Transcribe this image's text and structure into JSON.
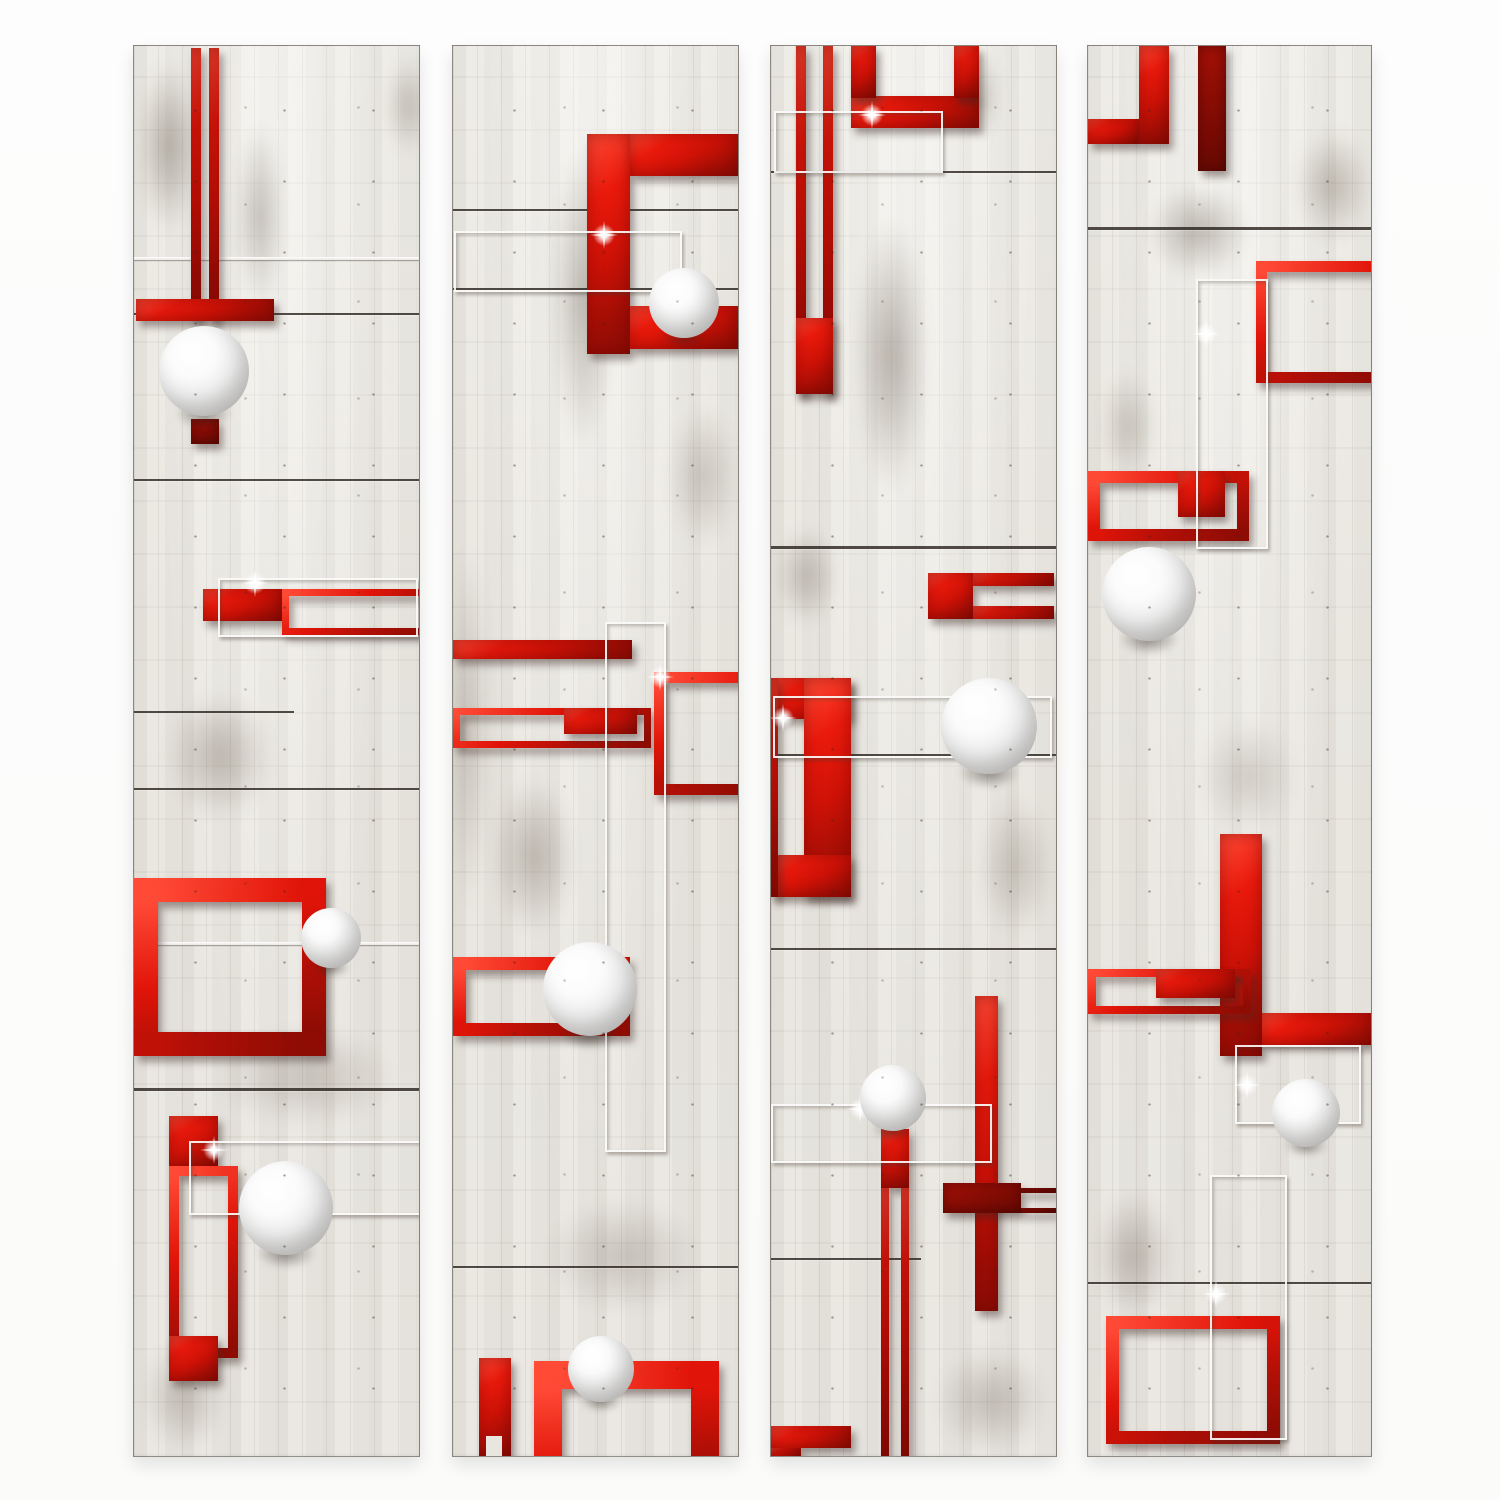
{
  "artwork": {
    "kind": "decorative wallpaper mural, abstract 3D composition",
    "motifs": "concrete/wood plank panels, glossy red rectangles and frames, white 3D spheres, thin silver wire frames"
  },
  "palette": {
    "page_bg": "#fcfcfc",
    "panel_bg": "#eae7e1",
    "red_bright": "#ea1a0c",
    "red_deep": "#8d0c04",
    "dark_red": "#8a0d05",
    "seam": "#231c16",
    "wire_silver": "#faf9f7",
    "sphere_white": "#ffffff",
    "sphere_edge": "#b9b9ba"
  },
  "canvas": {
    "w": 1500,
    "h": 1500
  },
  "panels": [
    {
      "id": "panel-1",
      "x": 133,
      "y": 45,
      "w": 285,
      "h": 1410,
      "shapes": [
        {
          "t": "smudge",
          "x": -10,
          "y": -20,
          "w": 90,
          "h": 240,
          "a": 0.5
        },
        {
          "t": "smudge",
          "x": 90,
          "y": 40,
          "w": 70,
          "h": 260,
          "a": 0.4
        },
        {
          "t": "smudge",
          "x": 240,
          "y": -10,
          "w": 70,
          "h": 140,
          "a": 0.35
        },
        {
          "t": "smudge",
          "x": 10,
          "y": 620,
          "w": 150,
          "h": 180,
          "a": 0.4
        },
        {
          "t": "smudge",
          "x": 40,
          "y": 960,
          "w": 260,
          "h": 140,
          "a": 0.3
        },
        {
          "t": "smudge",
          "x": -10,
          "y": 1270,
          "w": 120,
          "h": 160,
          "a": 0.35
        },
        {
          "t": "seam",
          "x": 0,
          "y": 267,
          "w": 285,
          "h": 2
        },
        {
          "t": "seam",
          "x": 0,
          "y": 433,
          "w": 285,
          "h": 2
        },
        {
          "t": "seam",
          "x": 0,
          "y": 665,
          "w": 160,
          "h": 2
        },
        {
          "t": "seam",
          "x": 0,
          "y": 742,
          "w": 285,
          "h": 2
        },
        {
          "t": "seam",
          "x": 0,
          "y": 1042,
          "w": 285,
          "h": 3
        },
        {
          "t": "wireline",
          "x": 0,
          "y": 211,
          "w": 285,
          "h": 3
        },
        {
          "t": "wireline",
          "x": 0,
          "y": 896,
          "w": 285,
          "h": 3
        },
        {
          "t": "bar",
          "x": 57,
          "y": 2,
          "w": 10,
          "h": 273
        },
        {
          "t": "bar",
          "x": 75,
          "y": 2,
          "w": 10,
          "h": 273
        },
        {
          "t": "bar",
          "x": 2,
          "y": 253,
          "w": 138,
          "h": 22
        },
        {
          "t": "bar",
          "x": 57,
          "y": 373,
          "w": 28,
          "h": 25,
          "c": "darkred"
        },
        {
          "t": "bar",
          "x": 69,
          "y": 543,
          "w": 79,
          "h": 32
        },
        {
          "t": "frame",
          "x": 148,
          "y": 543,
          "w": 137,
          "h": 32,
          "bw": 7
        },
        {
          "t": "frame",
          "x": 0,
          "y": 832,
          "w": 144,
          "h": 130,
          "bw": 24
        },
        {
          "t": "bar",
          "x": 35,
          "y": 1070,
          "w": 49,
          "h": 52
        },
        {
          "t": "frame",
          "x": 35,
          "y": 1120,
          "w": 49,
          "h": 172,
          "bw": 10
        },
        {
          "t": "bar",
          "x": 35,
          "y": 1290,
          "w": 49,
          "h": 45
        },
        {
          "t": "wire",
          "x": 84,
          "y": 532,
          "w": 196,
          "h": 55,
          "sp": [
            0.18,
            0.06
          ]
        },
        {
          "t": "wire",
          "x": 55,
          "y": 1095,
          "w": 231,
          "h": 70,
          "sp": [
            0.1,
            0.1
          ]
        },
        {
          "t": "sphere",
          "cx": 70,
          "cy": 325,
          "r": 45
        },
        {
          "t": "sphere",
          "cx": 197,
          "cy": 892,
          "r": 30
        },
        {
          "t": "sphere",
          "cx": 152,
          "cy": 1162,
          "r": 47
        }
      ]
    },
    {
      "id": "panel-2",
      "x": 452,
      "y": 45,
      "w": 285,
      "h": 1410,
      "shapes": [
        {
          "t": "smudge",
          "x": -15,
          "y": 420,
          "w": 60,
          "h": 520,
          "a": 0.35
        },
        {
          "t": "smudge",
          "x": 85,
          "y": 40,
          "w": 90,
          "h": 420,
          "a": 0.45
        },
        {
          "t": "smudge",
          "x": 20,
          "y": 700,
          "w": 120,
          "h": 220,
          "a": 0.4
        },
        {
          "t": "smudge",
          "x": 60,
          "y": 1130,
          "w": 220,
          "h": 160,
          "a": 0.3
        },
        {
          "t": "smudge",
          "x": 200,
          "y": 330,
          "w": 100,
          "h": 200,
          "a": 0.3
        },
        {
          "t": "seam",
          "x": 0,
          "y": 163,
          "w": 285,
          "h": 2
        },
        {
          "t": "seam",
          "x": 0,
          "y": 242,
          "w": 285,
          "h": 2
        },
        {
          "t": "seam",
          "x": 0,
          "y": 1220,
          "w": 285,
          "h": 2
        },
        {
          "t": "bar",
          "x": 134,
          "y": 88,
          "w": 43,
          "h": 220
        },
        {
          "t": "bar",
          "x": 177,
          "y": 88,
          "w": 108,
          "h": 42
        },
        {
          "t": "bar",
          "x": 177,
          "y": 260,
          "w": 108,
          "h": 43
        },
        {
          "t": "bar",
          "x": 0,
          "y": 594,
          "w": 179,
          "h": 19
        },
        {
          "t": "frame",
          "x": 0,
          "y": 662,
          "w": 184,
          "h": 26,
          "bw": 7
        },
        {
          "t": "bar",
          "x": 111,
          "y": 662,
          "w": 73,
          "h": 26
        },
        {
          "t": "frame",
          "x": 201,
          "y": 626,
          "w": 81,
          "h": 101,
          "bw": 11
        },
        {
          "t": "frame",
          "x": 0,
          "y": 911,
          "w": 151,
          "h": 53,
          "bw": 13
        },
        {
          "t": "bar",
          "x": 26,
          "y": 1312,
          "w": 32,
          "h": 98
        },
        {
          "t": "hole",
          "x": 33,
          "y": 1390,
          "w": 16,
          "h": 20
        },
        {
          "t": "frame",
          "x": 81,
          "y": 1315,
          "w": 129,
          "h": 120,
          "bw": 28
        },
        {
          "t": "wire",
          "x": 1,
          "y": 185,
          "w": 224,
          "h": 57,
          "sp": [
            0.66,
            0.04
          ]
        },
        {
          "t": "wire",
          "x": 152,
          "y": 576,
          "w": 57,
          "h": 526,
          "sp": [
            0.93,
            0.1
          ]
        },
        {
          "t": "sphere",
          "cx": 231,
          "cy": 257,
          "r": 35
        },
        {
          "t": "sphere",
          "cx": 137,
          "cy": 943,
          "r": 47
        },
        {
          "t": "sphere",
          "cx": 148,
          "cy": 1323,
          "r": 33
        }
      ]
    },
    {
      "id": "panel-3",
      "x": 770,
      "y": 45,
      "w": 285,
      "h": 1410,
      "shapes": [
        {
          "t": "smudge",
          "x": 70,
          "y": 120,
          "w": 100,
          "h": 380,
          "a": 0.5
        },
        {
          "t": "smudge",
          "x": -10,
          "y": 460,
          "w": 90,
          "h": 140,
          "a": 0.4
        },
        {
          "t": "smudge",
          "x": 190,
          "y": 720,
          "w": 110,
          "h": 200,
          "a": 0.3
        },
        {
          "t": "smudge",
          "x": 140,
          "y": 1280,
          "w": 160,
          "h": 150,
          "a": 0.35
        },
        {
          "t": "smudge",
          "x": 180,
          "y": -10,
          "w": 60,
          "h": 120,
          "a": 0.3
        },
        {
          "t": "seam",
          "x": 0,
          "y": 125,
          "w": 285,
          "h": 2
        },
        {
          "t": "seam",
          "x": 0,
          "y": 500,
          "w": 285,
          "h": 3
        },
        {
          "t": "seam",
          "x": 0,
          "y": 708,
          "w": 285,
          "h": 2
        },
        {
          "t": "seam",
          "x": 0,
          "y": 902,
          "w": 285,
          "h": 2
        },
        {
          "t": "seam",
          "x": 0,
          "y": 1212,
          "w": 150,
          "h": 2
        },
        {
          "t": "bar",
          "x": 25,
          "y": 0,
          "w": 10,
          "h": 348
        },
        {
          "t": "bar",
          "x": 52,
          "y": 0,
          "w": 10,
          "h": 348
        },
        {
          "t": "bar",
          "x": 25,
          "y": 272,
          "w": 37,
          "h": 76
        },
        {
          "t": "bar",
          "x": 80,
          "y": 50,
          "w": 128,
          "h": 32
        },
        {
          "t": "bar",
          "x": 80,
          "y": 0,
          "w": 25,
          "h": 52
        },
        {
          "t": "bar",
          "x": 183,
          "y": 0,
          "w": 25,
          "h": 52
        },
        {
          "t": "bar",
          "x": 157,
          "y": 527,
          "w": 45,
          "h": 46
        },
        {
          "t": "bar",
          "x": 202,
          "y": 527,
          "w": 81,
          "h": 13
        },
        {
          "t": "bar",
          "x": 202,
          "y": 560,
          "w": 81,
          "h": 13
        },
        {
          "t": "bar",
          "x": 0,
          "y": 632,
          "w": 80,
          "h": 41
        },
        {
          "t": "bar",
          "x": 33,
          "y": 632,
          "w": 47,
          "h": 219
        },
        {
          "t": "bar",
          "x": 0,
          "y": 809,
          "w": 80,
          "h": 42
        },
        {
          "t": "bar",
          "x": 0,
          "y": 632,
          "w": 7,
          "h": 219
        },
        {
          "t": "bar",
          "x": 204,
          "y": 950,
          "w": 23,
          "h": 315
        },
        {
          "t": "bar",
          "x": 110,
          "y": 1083,
          "w": 28,
          "h": 59
        },
        {
          "t": "bar",
          "x": 110,
          "y": 1142,
          "w": 8,
          "h": 268
        },
        {
          "t": "bar",
          "x": 130,
          "y": 1142,
          "w": 8,
          "h": 268
        },
        {
          "t": "bar",
          "x": 172,
          "y": 1137,
          "w": 78,
          "h": 30,
          "c": "darkred"
        },
        {
          "t": "bar",
          "x": 250,
          "y": 1142,
          "w": 35,
          "h": 5,
          "c": "darkred"
        },
        {
          "t": "bar",
          "x": 250,
          "y": 1162,
          "w": 35,
          "h": 5,
          "c": "darkred"
        },
        {
          "t": "bar",
          "x": 0,
          "y": 1380,
          "w": 80,
          "h": 22
        },
        {
          "t": "bar",
          "x": 0,
          "y": 1402,
          "w": 30,
          "h": 8
        },
        {
          "t": "wire",
          "x": 3,
          "y": 65,
          "w": 165,
          "h": 58,
          "sp": [
            0.58,
            0.03
          ]
        },
        {
          "t": "wire",
          "x": 2,
          "y": 650,
          "w": 275,
          "h": 58,
          "sp": [
            0.03,
            0.35
          ]
        },
        {
          "t": "wire",
          "x": 0,
          "y": 1058,
          "w": 217,
          "h": 55,
          "sp": [
            0.4,
            0.05
          ]
        },
        {
          "t": "sphere",
          "cx": 218,
          "cy": 680,
          "r": 48
        },
        {
          "t": "sphere",
          "cx": 122,
          "cy": 1052,
          "r": 33
        }
      ]
    },
    {
      "id": "panel-4",
      "x": 1087,
      "y": 45,
      "w": 283,
      "h": 1410,
      "shapes": [
        {
          "t": "smudge",
          "x": 190,
          "y": 60,
          "w": 110,
          "h": 160,
          "a": 0.4
        },
        {
          "t": "smudge",
          "x": 40,
          "y": 120,
          "w": 140,
          "h": 130,
          "a": 0.45
        },
        {
          "t": "smudge",
          "x": -10,
          "y": 1120,
          "w": 110,
          "h": 180,
          "a": 0.4
        },
        {
          "t": "smudge",
          "x": 90,
          "y": 650,
          "w": 140,
          "h": 160,
          "a": 0.25
        },
        {
          "t": "smudge",
          "x": 0,
          "y": 300,
          "w": 80,
          "h": 160,
          "a": 0.3
        },
        {
          "t": "seam",
          "x": 0,
          "y": 181,
          "w": 283,
          "h": 3
        },
        {
          "t": "seam",
          "x": 0,
          "y": 1236,
          "w": 283,
          "h": 2
        },
        {
          "t": "bar",
          "x": 0,
          "y": 73,
          "w": 51,
          "h": 25
        },
        {
          "t": "bar",
          "x": 51,
          "y": 0,
          "w": 30,
          "h": 98
        },
        {
          "t": "bar",
          "x": 110,
          "y": 0,
          "w": 28,
          "h": 125,
          "c": "darkred"
        },
        {
          "t": "frame",
          "x": 168,
          "y": 215,
          "w": 110,
          "h": 100,
          "bw": 11
        },
        {
          "t": "frame",
          "x": 0,
          "y": 425,
          "w": 137,
          "h": 46,
          "bw": 12
        },
        {
          "t": "bar",
          "x": 90,
          "y": 425,
          "w": 47,
          "h": 46
        },
        {
          "t": "bar",
          "x": 132,
          "y": 788,
          "w": 42,
          "h": 222
        },
        {
          "t": "bar",
          "x": 174,
          "y": 967,
          "w": 111,
          "h": 32
        },
        {
          "t": "frame",
          "x": 0,
          "y": 923,
          "w": 147,
          "h": 29,
          "bw": 8
        },
        {
          "t": "bar",
          "x": 68,
          "y": 923,
          "w": 79,
          "h": 29
        },
        {
          "t": "frame",
          "x": 18,
          "y": 1270,
          "w": 148,
          "h": 102,
          "bw": 13
        },
        {
          "t": "wire",
          "x": 108,
          "y": 233,
          "w": 68,
          "h": 266,
          "sp": [
            0.12,
            0.2
          ]
        },
        {
          "t": "wire",
          "x": 147,
          "y": 999,
          "w": 122,
          "h": 75,
          "sp": [
            0.08,
            0.5
          ]
        },
        {
          "t": "wire",
          "x": 122,
          "y": 1129,
          "w": 73,
          "h": 261,
          "sp": [
            0.06,
            0.45
          ]
        },
        {
          "t": "sphere",
          "cx": 61,
          "cy": 548,
          "r": 47
        },
        {
          "t": "sphere",
          "cx": 218,
          "cy": 1067,
          "r": 34
        }
      ]
    }
  ]
}
